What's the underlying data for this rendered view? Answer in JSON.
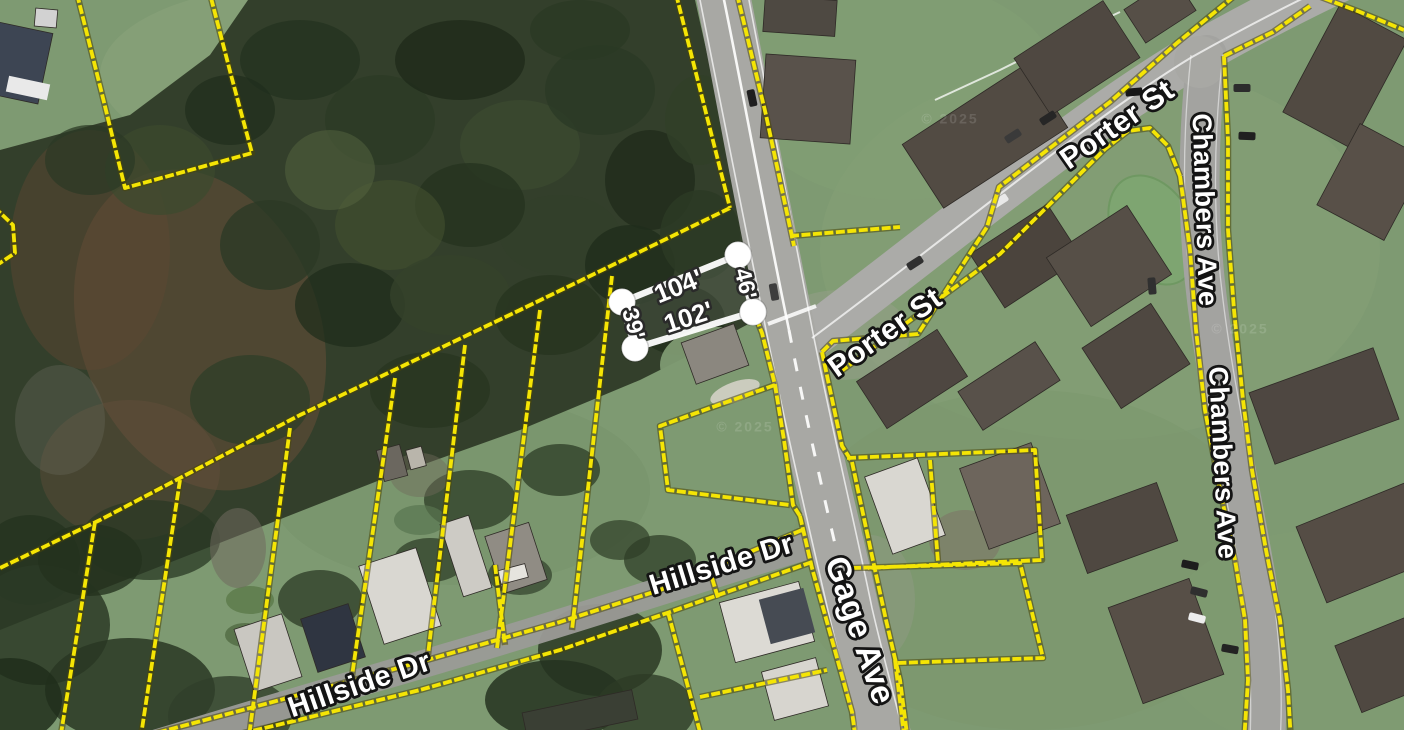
{
  "title": "Aerial parcel map",
  "streets": {
    "porter_upper": "Porter St",
    "porter_lower": "Porter St",
    "chambers_upper": "Chambers Ave",
    "chambers_lower": "Chambers Ave",
    "hillside_east": "Hillside Dr",
    "hillside_west": "Hillside Dr",
    "gage": "Gage Ave"
  },
  "parcel": {
    "edge_labels": {
      "top": "104'",
      "bottom": "102'",
      "left": "39'",
      "right": "46'"
    }
  },
  "watermark": "© 2025",
  "colors": {
    "parcel_line": "#f5e504",
    "highlight": "#ffffff",
    "road": "#a8a8a4",
    "grass": "#7e9a72",
    "forest": "#333f2b",
    "building": "#4f4841"
  }
}
